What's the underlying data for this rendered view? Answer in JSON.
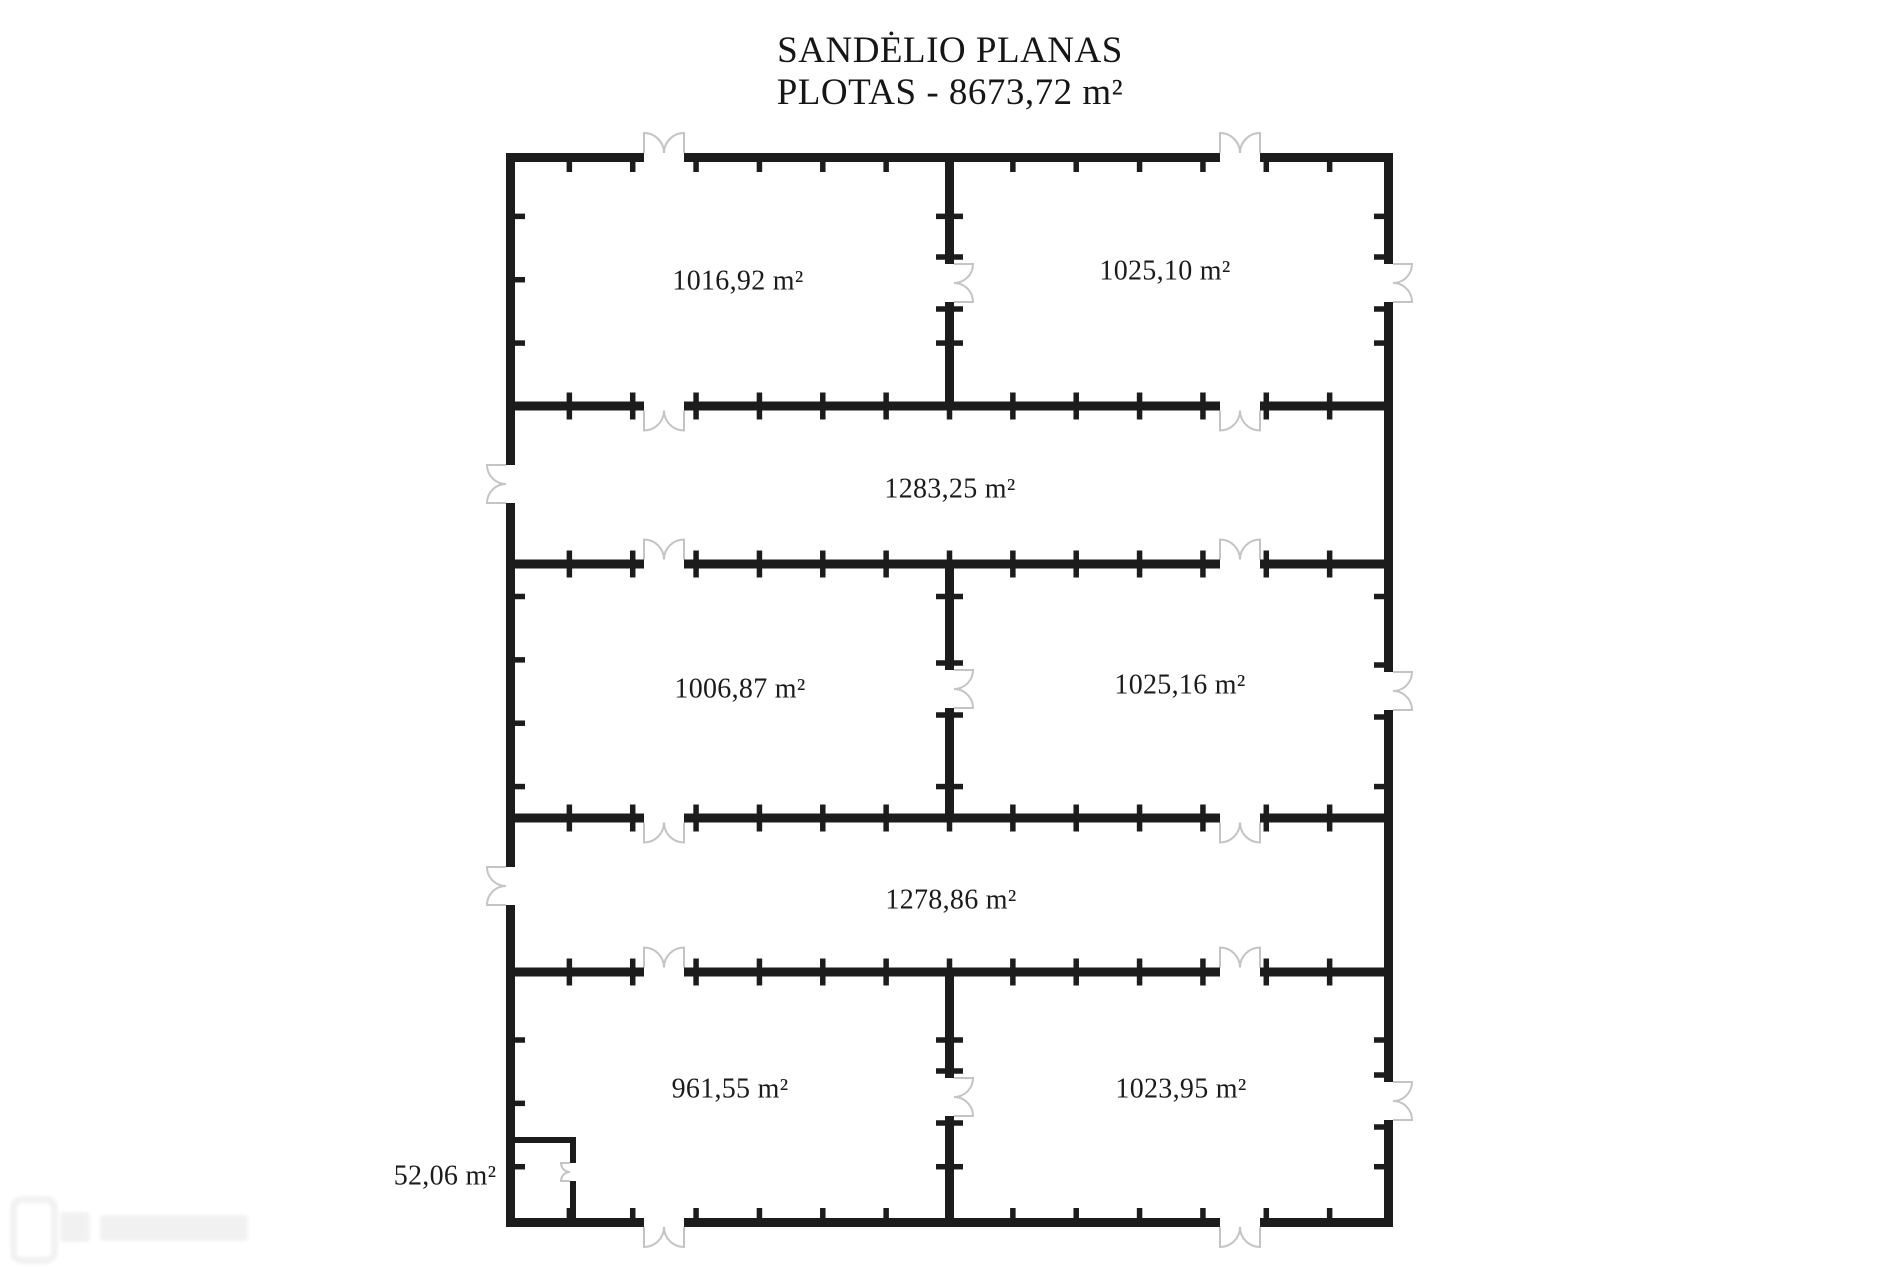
{
  "title": {
    "line1": "SANDĖLIO PLANAS",
    "line2": "PLOTAS - 8673,72 m²"
  },
  "plan": {
    "total_area": "8673,72 m²",
    "rooms": [
      {
        "id": "room-top-left",
        "area_label": "1016,92 m²"
      },
      {
        "id": "room-top-right",
        "area_label": "1025,10 m²"
      },
      {
        "id": "corridor-upper",
        "area_label": "1283,25 m²"
      },
      {
        "id": "room-middle-left",
        "area_label": "1006,87 m²"
      },
      {
        "id": "room-middle-right",
        "area_label": "1025,16 m²"
      },
      {
        "id": "corridor-lower",
        "area_label": "1278,86 m²"
      },
      {
        "id": "room-bottom-left",
        "area_label": "961,55 m²"
      },
      {
        "id": "room-bottom-right",
        "area_label": "1023,95 m²"
      },
      {
        "id": "room-small",
        "area_label": "52,06 m²"
      }
    ]
  },
  "colors": {
    "wall": "#1c1c1c",
    "tick": "#1c1c1c",
    "door": "#c4c4c4",
    "text": "#1b1b1b",
    "background": "#ffffff"
  }
}
